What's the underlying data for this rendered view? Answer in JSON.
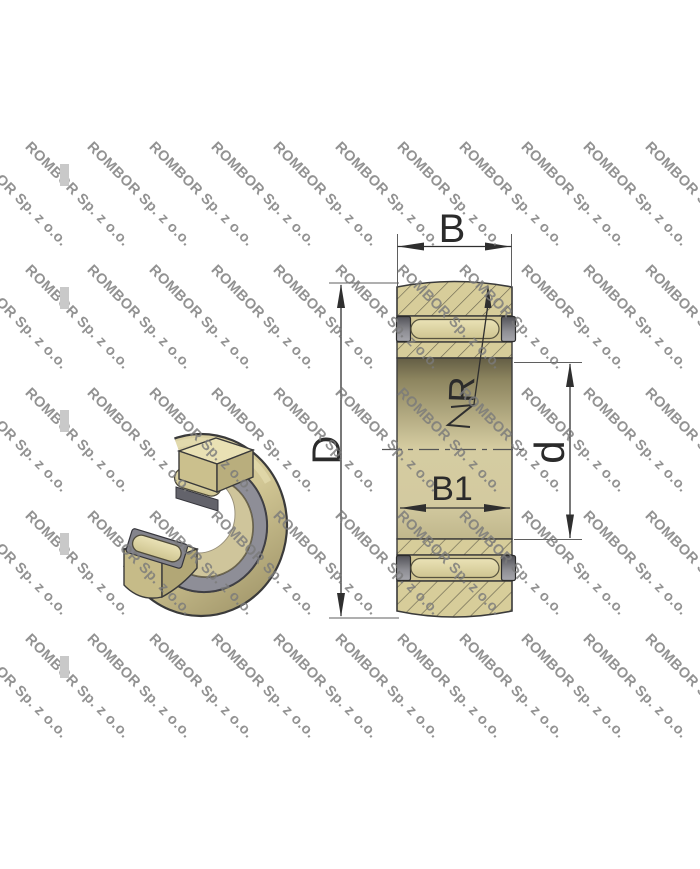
{
  "watermark": {
    "text": "ROMBOR Sp. z o.o."
  },
  "diagram": {
    "type": "bearing-cross-section-technical-drawing",
    "labels": {
      "outer_ring_width": "B",
      "inner_ring_width": "B1",
      "outer_diameter": "D",
      "bore_diameter": "d",
      "crown_radius": "R"
    }
  },
  "colors": {
    "ring_tan": "#d7cd9a",
    "hatch_line": "#6e6952",
    "roller_light": "#ddd4a6",
    "end_washer_gray": "#707076",
    "seal_band_gray": "#8e8e97",
    "outline": "#3a3a3a",
    "watermark_gray": "#9b9b9b",
    "background": "#ffffff"
  }
}
